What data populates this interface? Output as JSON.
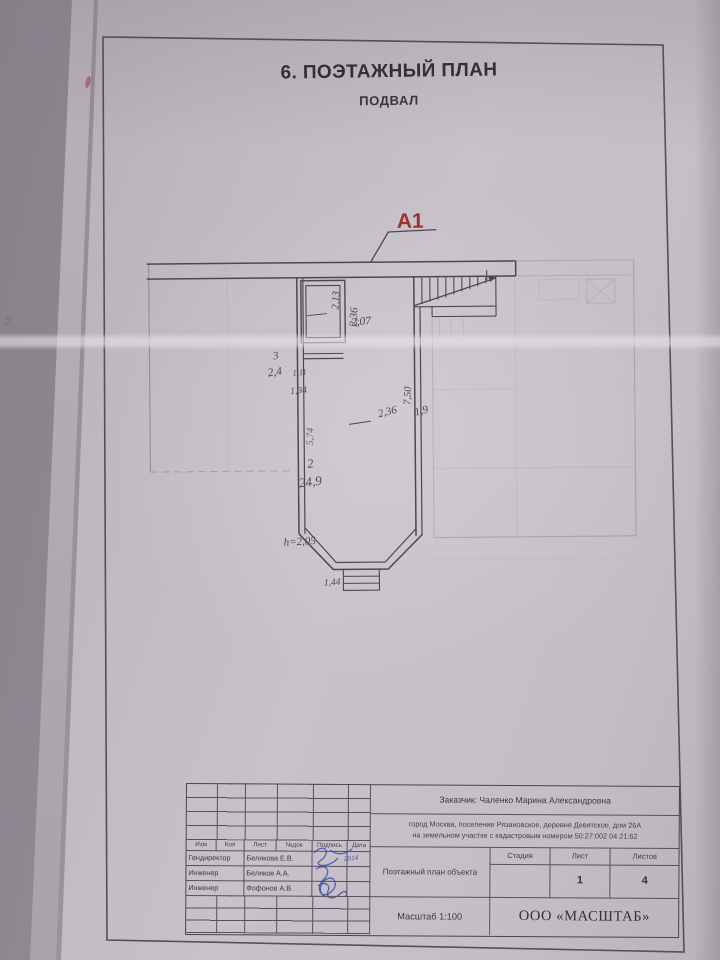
{
  "document": {
    "title": "6. ПОЭТАЖНЫЙ ПЛАН",
    "subtitle": "ПОДВАЛ",
    "edge_mark": "№"
  },
  "plan": {
    "section_marker": "А1",
    "marker_color": "#993231",
    "ink_color": "#4e4653",
    "room2": {
      "number": "2",
      "area": "24,9"
    },
    "room3": {
      "number": "3",
      "area": "2,4"
    },
    "dims": {
      "top_width": "2,07",
      "stair_run": "2,36",
      "stair_width": "1,9",
      "room3_height": "2,13",
      "hall_height": "2,36",
      "niche_width": "1,11",
      "niche_outer_width": "1,34",
      "right_wall_height": "7,50",
      "left_wall_height": "5,74",
      "ceiling_note": "h=2,05",
      "bay_left": "1,43",
      "bay_front": "1,44",
      "bay_right": "1,43"
    }
  },
  "titleblock": {
    "client": "Заказчик: Чаленко Марина Александровна",
    "address_line1": "город Москва, поселение Рязановское, деревня Девятское, дом 26А",
    "address_line2": "на земельном участке с кадастровым номером  50:27:002 04 21:62",
    "header_cols": [
      "Изм",
      "Кол",
      "Лист",
      "№док",
      "Подпись",
      "Дата"
    ],
    "staff": [
      {
        "role": "Гендиректор",
        "name": "Белякова Е.В.",
        "date": "2014"
      },
      {
        "role": "Инженер",
        "name": "Беляков А.А.",
        "date": ""
      },
      {
        "role": "Инженер",
        "name": "Фофонов А.В.",
        "date": ""
      }
    ],
    "doc_title": "Поэтажный план объекта",
    "stage_label": "Стадия",
    "sheet_label": "Лист",
    "sheets_label": "Листов",
    "stage_value": "",
    "sheet_value": "1",
    "sheets_value": "4",
    "scale": "Масштаб 1:100",
    "company": "ООО «МАСШТАБ»"
  }
}
